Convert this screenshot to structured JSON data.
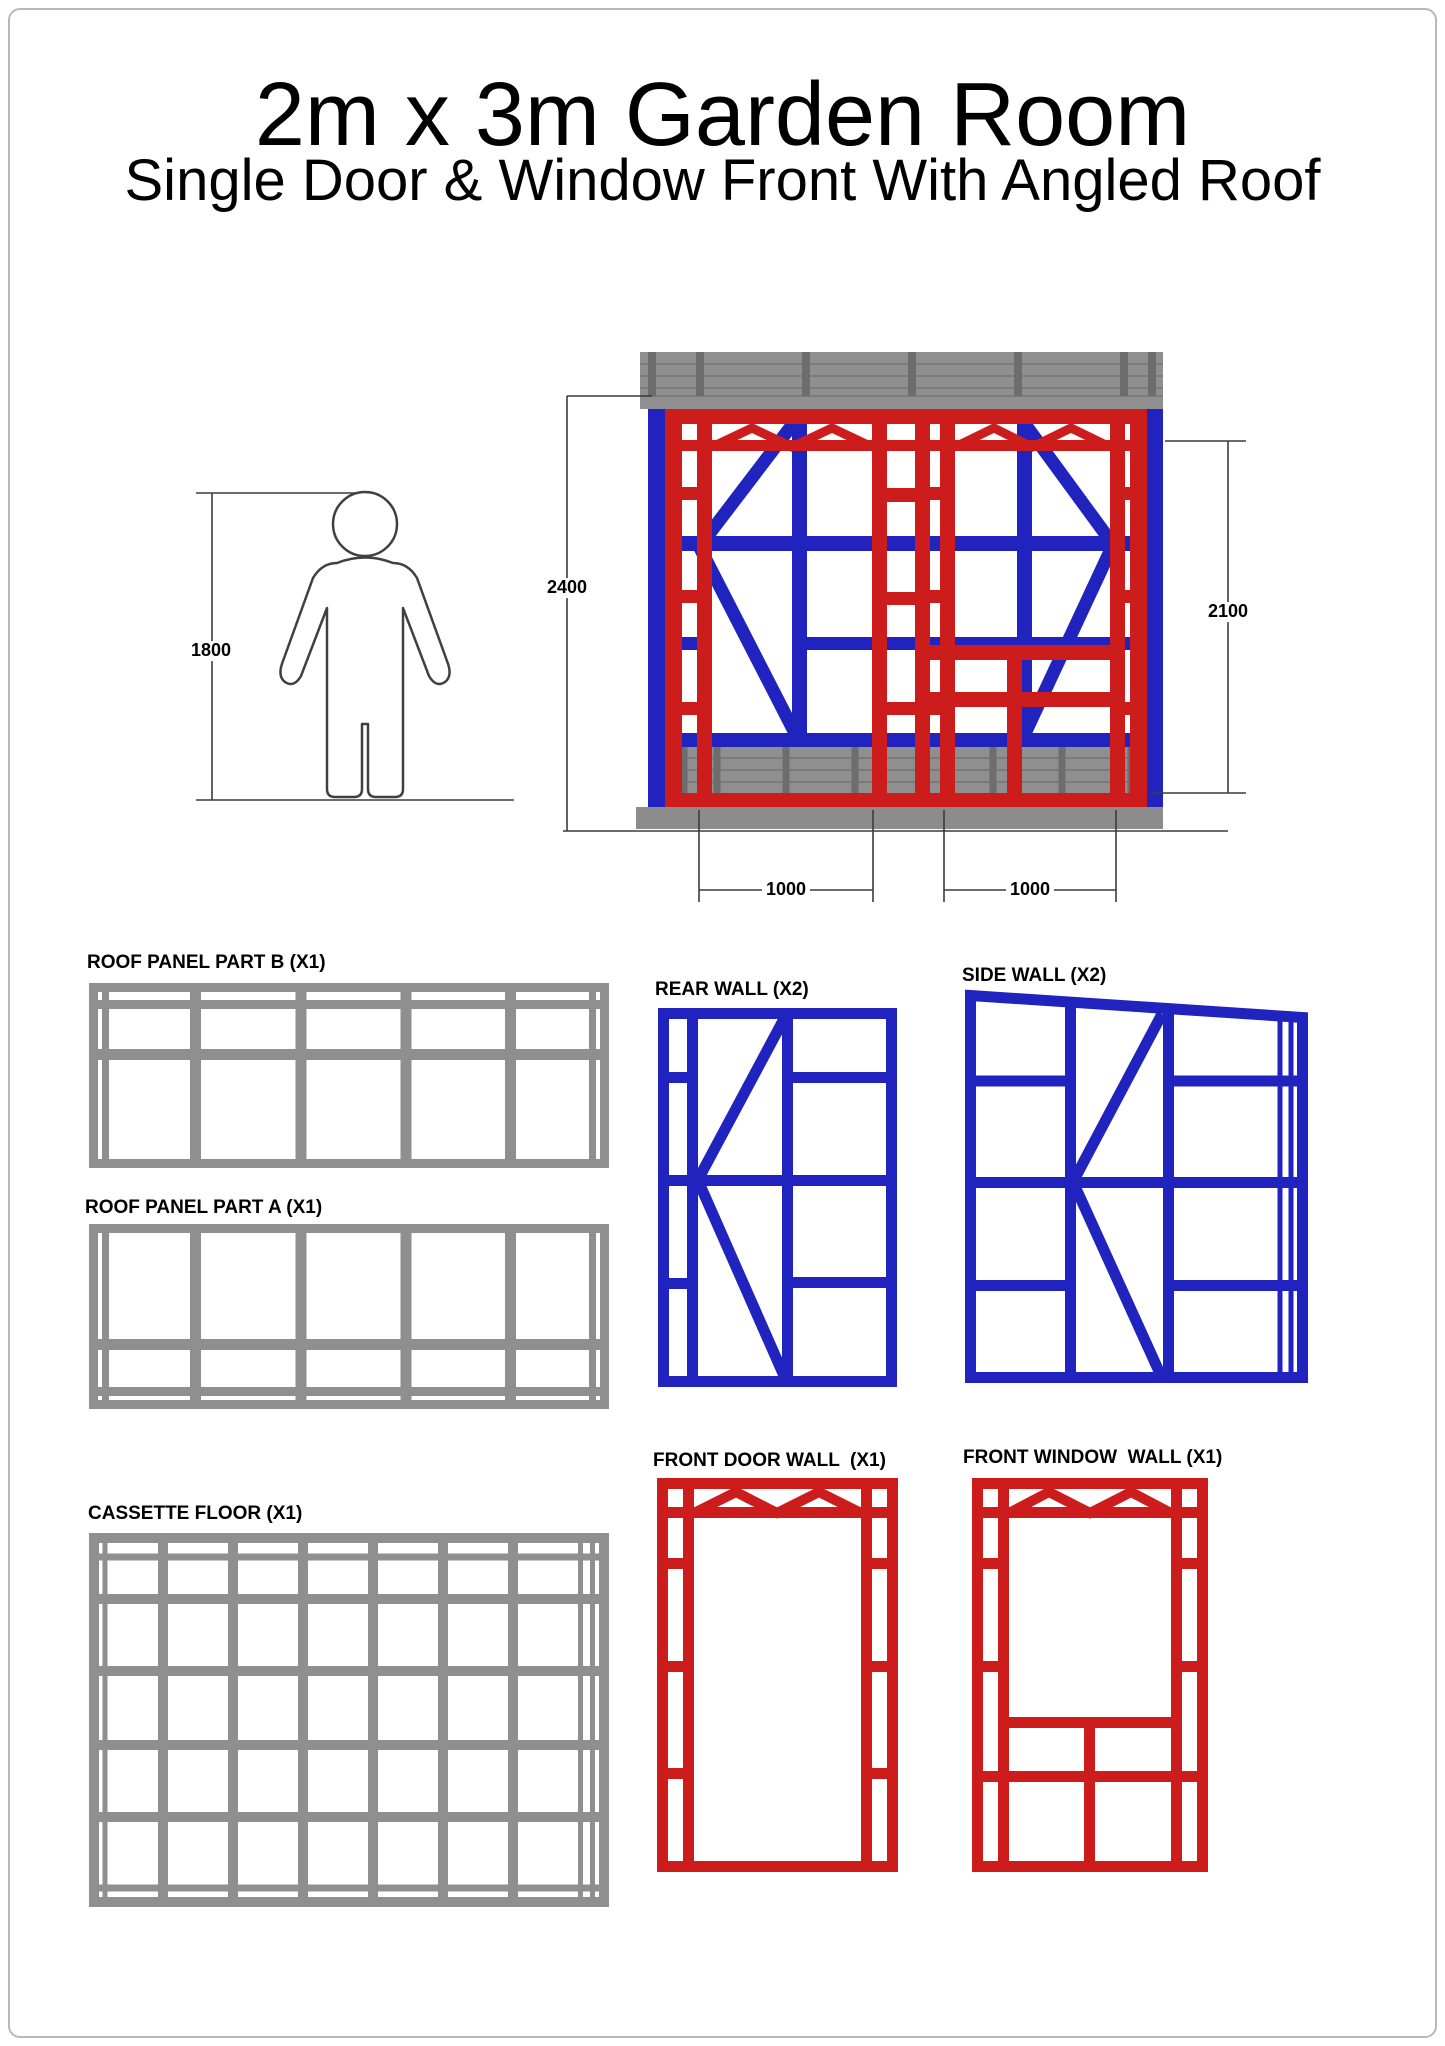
{
  "sheet": {
    "title": "2m x 3m Garden Room",
    "subtitle": "Single Door & Window Front With Angled Roof"
  },
  "colors": {
    "red": "#cc1c1c",
    "blue": "#2023bd",
    "gray": "#8f8f8f",
    "gray_dark": "#6d6d6d",
    "gray_lines": "#7b7b7b",
    "ground": "#8c8c8c",
    "dimension_lines": "#3c3c3c",
    "sheet_border": "#b8b8b8",
    "person_outline": "#404040"
  },
  "elevation": {
    "dim_overall_height": "2400",
    "dim_wall_height": "2100",
    "dim_person_height": "1800",
    "dim_door_width": "1000",
    "dim_window_width": "1000"
  },
  "panels": {
    "roof_b": "ROOF PANEL PART B (X1)",
    "roof_a": "ROOF PANEL PART A (X1)",
    "floor": "CASSETTE FLOOR (X1)",
    "rear": "REAR WALL (X2)",
    "side": "SIDE WALL (X2)",
    "door": "FRONT DOOR WALL  (X1)",
    "window": "FRONT WINDOW  WALL (X1)"
  }
}
